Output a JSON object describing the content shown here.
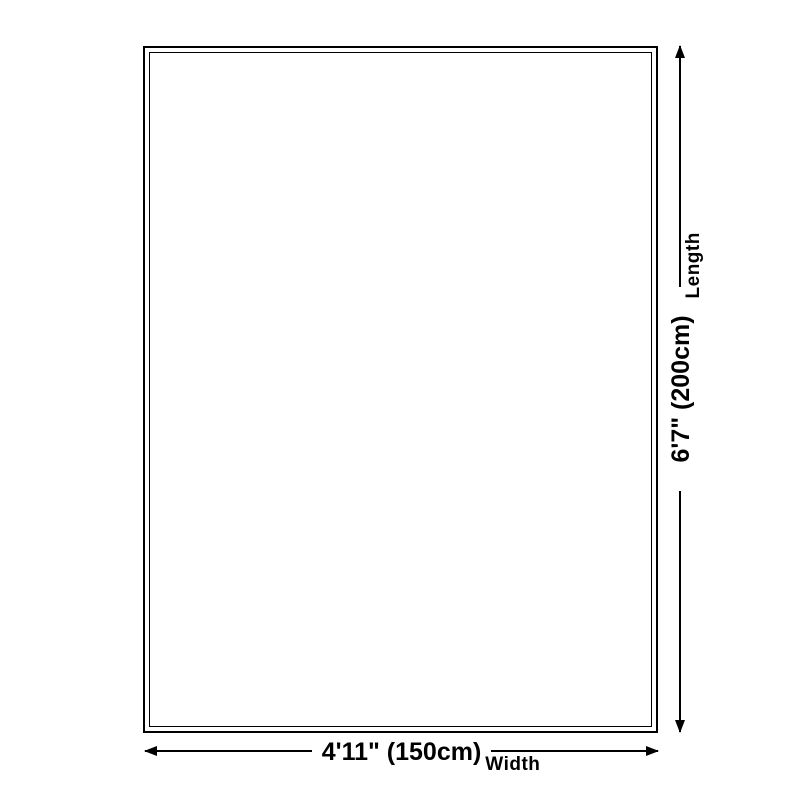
{
  "colors": {
    "ink": "#000000",
    "background": "#ffffff"
  },
  "dimensions": {
    "length": {
      "value": "6'7\" (200cm)",
      "label": "Length"
    },
    "width": {
      "value": "4'11\" (150cm)",
      "label": "Width"
    }
  }
}
